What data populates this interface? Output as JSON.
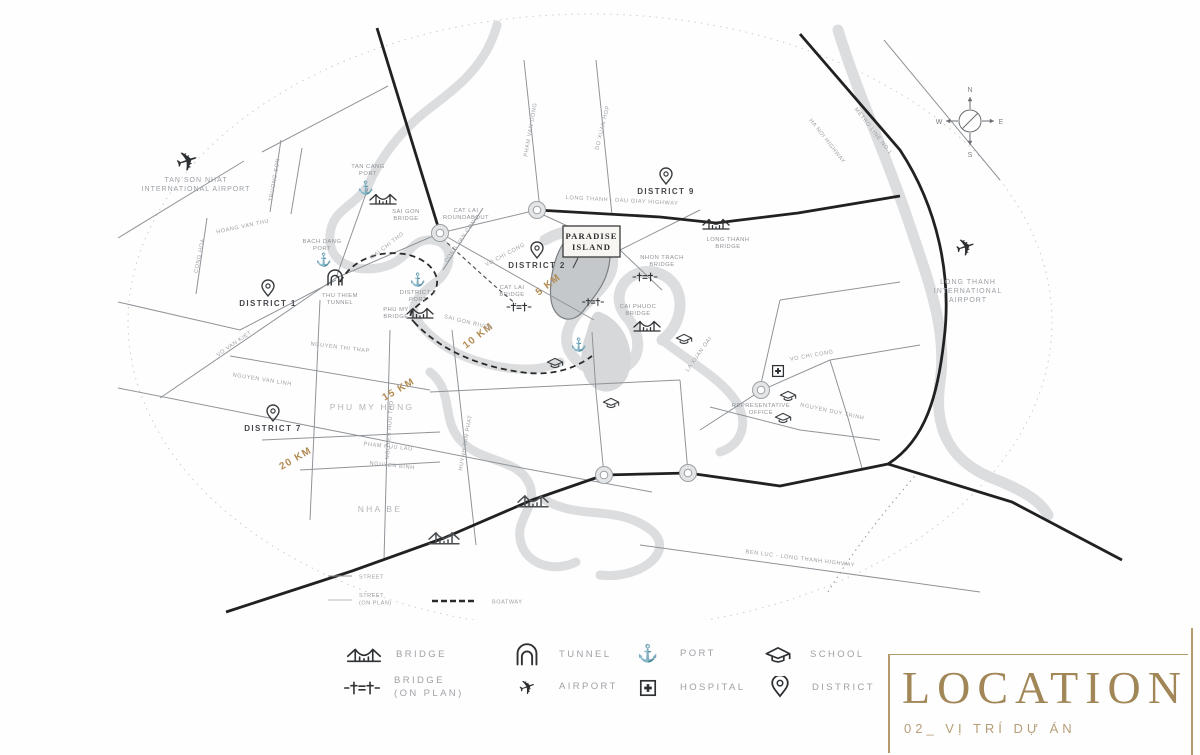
{
  "colors": {
    "gold_accent": "#b49a6a",
    "km_gold": "#b28a50",
    "road_black": "#212121",
    "road_gray": "#8f9499",
    "river_gray": "#dbdddf",
    "title_gold": "#a18757"
  },
  "icons": {
    "port": "⚓",
    "airport": "✈"
  },
  "project": {
    "line1": "PARADISE",
    "line2": "ISLAND"
  },
  "compass": {
    "n": "N",
    "e": "E",
    "s": "S",
    "w": "W"
  },
  "airports": {
    "tsn1": "TAN SON NHAT",
    "tsn2": "INTERNATIONAL AIRPORT",
    "lt1": "LONG THANH",
    "lt2": "INTERNATIONAL",
    "lt3": "AIRPORT"
  },
  "districts": {
    "d1": "DISTRICT 1",
    "d2": "DISTRICT 2",
    "d7": "DISTRICT 7",
    "d9": "DISTRICT 9"
  },
  "areas": {
    "phu_my_hung": "PHU MY HUNG",
    "nha_be": "NHA BE"
  },
  "distance_rings": {
    "km5": "5 KM",
    "km10": "10 KM",
    "km15": "15 KM",
    "km20": "20 KM"
  },
  "pois": {
    "tan_cang_port1": "TAN CANG",
    "tan_cang_port2": "PORT",
    "sai_gon_bridge1": "SAI GON",
    "sai_gon_bridge2": "BRIDGE",
    "bach_dang_port1": "BACH DANG",
    "bach_dang_port2": "PORT",
    "thu_thiem_tunnel1": "THU THIEM",
    "thu_thiem_tunnel2": "TUNNEL",
    "district2_port1": "DISTRICT 2",
    "district2_port2": "PORT",
    "phu_my_bridge1": "PHU MY",
    "phu_my_bridge2": "BRIDGE",
    "cat_lai_bridge1": "CAT LAI",
    "cat_lai_bridge2": "BRIDGE",
    "cat_lai_roundabout1": "CAT LAI",
    "cat_lai_roundabout2": "ROUNDABOUT",
    "nhon_trach_bridge1": "NHON TRACH",
    "nhon_trach_bridge2": "BRIDGE",
    "long_thanh_bridge1": "LONG THANH",
    "long_thanh_bridge2": "BRIDGE",
    "cai_phuoc_bridge1": "CAI PHUOC",
    "cai_phuoc_bridge2": "BRIDGE",
    "rep_office1": "REPRESENTATIVE",
    "rep_office2": "OFFICE"
  },
  "roads": {
    "lt_dg_highway": "LONG THANH - DAU GIAY HIGHWAY",
    "ha_noi_highway": "HA NOI HIGHWAY",
    "metro": "METRO LINE NO.1",
    "vo_van_kiet": "VO VAN KIET",
    "mai_chi_tho": "MAI CHI THO",
    "dong_van_cong": "DONG VAN CONG",
    "vo_chi_cong": "VO CHI CONG",
    "vo_chi_cong_e": "VO CHI CONG",
    "sai_gon_river": "SAI GON RIVER",
    "nguyen_thi_thap": "NGUYEN THI THAP",
    "nguyen_van_linh": "NGUYEN VAN LINH",
    "nguyen_huu_tho": "NGUYEN HUU THO",
    "huynh_tan_phat": "HUYNH TAN PHAT",
    "pham_huu_lau": "PHAM HUU LAU",
    "nguyen_binh": "NGUYEN BINH",
    "do_xuan_hop": "DO XUAN HOP",
    "pham_van_dong": "PHAM VAN DONG",
    "la_xuan_oai": "LA XUAN OAI",
    "nguyen_duy_trinh": "NGUYEN DUY TRINH",
    "ben_luc": "BEN LUC - LONG THANH HIGHWAY",
    "truong_son": "TRUONG SON",
    "cong_hoa": "CONG HOA",
    "hoang_van_thu": "HOANG VAN THU"
  },
  "map_mini_legend": {
    "street": "STREET",
    "street_on_plan1": "STREET",
    "street_on_plan2": "(ON PLAN)",
    "boatway": "BOATWAY"
  },
  "legend": {
    "bridge": "BRIDGE",
    "tunnel": "TUNNEL",
    "port": "PORT",
    "school": "SCHOOL",
    "bridge_on_plan1": "BRIDGE",
    "bridge_on_plan2": "(ON PLAN)",
    "airport": "AIRPORT",
    "hospital": "HOSPITAL",
    "district": "DISTRICT"
  },
  "title_block": {
    "title": "LOCATION",
    "subtitle": "02_ VỊ TRÍ DỰ ÁN"
  }
}
